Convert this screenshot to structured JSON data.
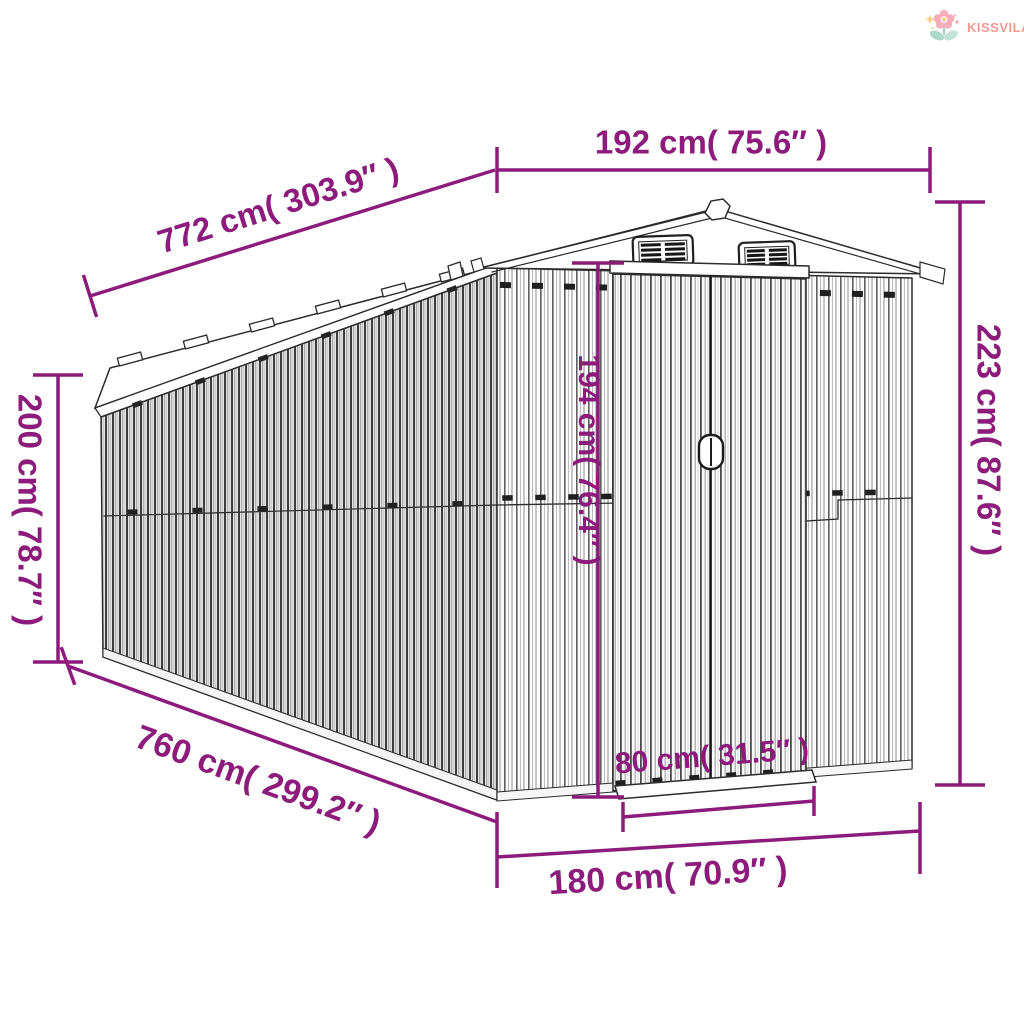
{
  "brand": {
    "name": "KISSVILÁG",
    "text_color": "#f19b90"
  },
  "diagram": {
    "subject": "garden-shed-dimension-drawing",
    "accent_color": "#8c1b7b",
    "dims": {
      "d192": {
        "label": "192 cm( 75.6″ )",
        "cm": 192,
        "inch": 75.6,
        "role": "front-roof-width"
      },
      "d772": {
        "label": "772 cm( 303.9″ )",
        "cm": 772,
        "inch": 303.9,
        "role": "roof-length"
      },
      "d200": {
        "label": "200 cm( 78.7″ )",
        "cm": 200,
        "inch": 78.7,
        "role": "side-wall-height"
      },
      "d223": {
        "label": "223 cm( 87.6″ )",
        "cm": 223,
        "inch": 87.6,
        "role": "total-height"
      },
      "d194": {
        "label": "194 cm( 76.4″ )",
        "cm": 194,
        "inch": 76.4,
        "role": "door-height"
      },
      "d80": {
        "label": "80 cm( 31.5″ )",
        "cm": 80,
        "inch": 31.5,
        "role": "door-width"
      },
      "d760": {
        "label": "760 cm( 299.2″ )",
        "cm": 760,
        "inch": 299.2,
        "role": "base-length"
      },
      "d180": {
        "label": "180 cm( 70.9″ )",
        "cm": 180,
        "inch": 70.9,
        "role": "base-width"
      }
    }
  }
}
